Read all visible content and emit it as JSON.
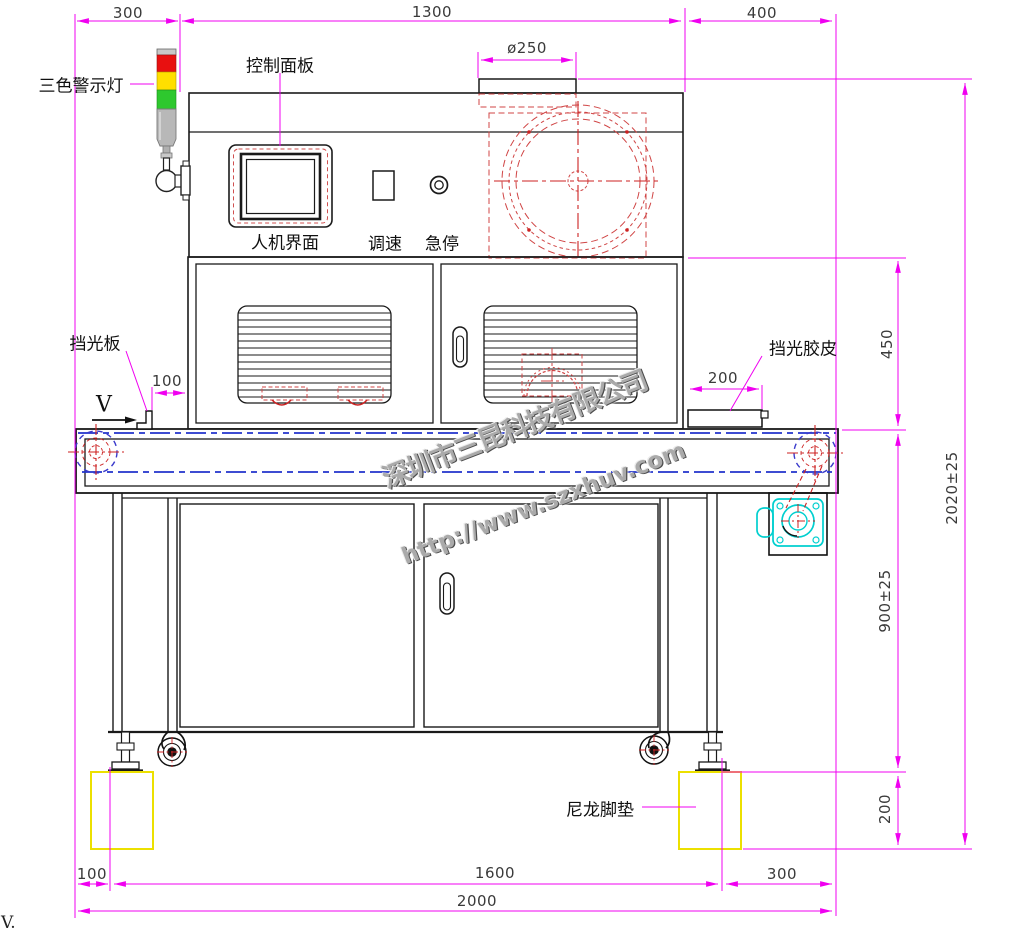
{
  "drawing": {
    "type": "engineering-front-view",
    "machine": "UV curing conveyor machine",
    "watermark": {
      "company": "深圳市三昆科技有限公司",
      "url": "http://www.szxhuv.com"
    },
    "labels": {
      "warning_light": "三色警示灯",
      "control_panel": "控制面板",
      "hmi": "人机界面",
      "speed": "调速",
      "estop": "急停",
      "shield_plate": "挡光板",
      "shield_rubber": "挡光胶皮",
      "nylon_pad": "尼龙脚垫",
      "direction": "V",
      "corner_note": "V."
    },
    "dimensions": {
      "top_left": "300",
      "top_center": "1300",
      "top_right": "400",
      "duct_diameter": "ø250",
      "shield_plate_offset": "100",
      "shield_rubber_length": "200",
      "right_lamp_section": "450",
      "right_total_height": "2020±25",
      "right_table_height": "900±25",
      "right_pad_height": "200",
      "bottom_left": "100",
      "bottom_center": "1600",
      "bottom_right": "300",
      "bottom_total": "2000"
    },
    "colors": {
      "dimension_magenta": "#f000f0",
      "hidden_red": "#d04545",
      "centerline_blue": "#2233cc",
      "motor_cyan": "#00cfcf",
      "pad_yellow": "#ece000",
      "lamp_red": "#e81010",
      "lamp_yellow": "#ffdf00",
      "lamp_green": "#2ec82e"
    }
  }
}
